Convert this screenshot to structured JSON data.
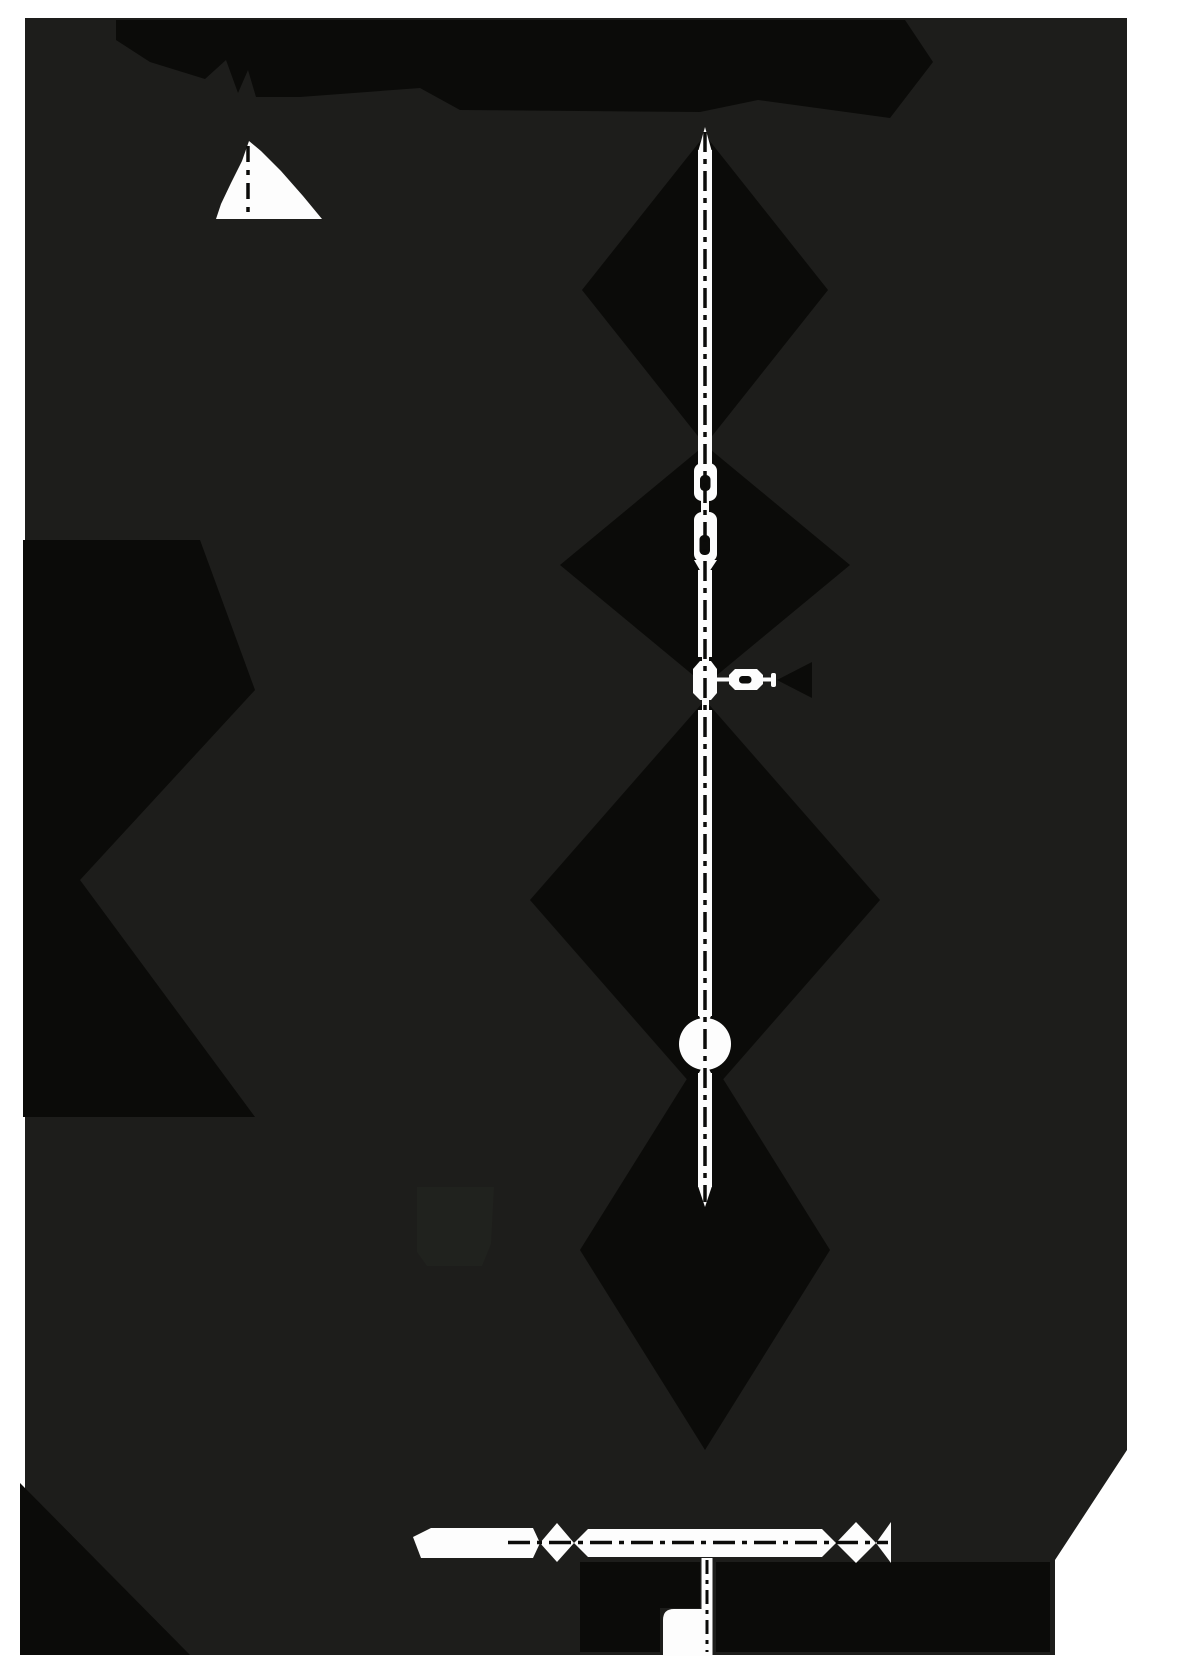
{
  "page": {
    "width": 1181,
    "height": 1680,
    "background": "#ffffff"
  },
  "figure": {
    "viewBox": "0 0 1181 1680",
    "palette": {
      "canvas": "#1d1d1b",
      "shadow": "#0b0b09",
      "white": "#fdfdfd",
      "ink": "#0b0b09",
      "faint_patch": "#20221e"
    },
    "elements": [
      {
        "name": "figure-background",
        "tag": "polygon",
        "attrs": {
          "points": "25,18 1127,18 1127,1450 1055,1560 1055,1655 25,1655",
          "fill": "#1d1d1b"
        }
      },
      {
        "name": "shadow-top-banner",
        "tag": "polygon",
        "attrs": {
          "points": "116,20 905,20 933,62 890,118 758,100 700,112 460,110 420,88 300,97 256,97 248,70 238,93 226,60 205,79 150,62 116,40",
          "fill": "#0b0b09"
        }
      },
      {
        "name": "shadow-diamond-upper",
        "tag": "polygon",
        "attrs": {
          "points": "705,135 828,290 705,445 582,290",
          "fill": "#0b0b09"
        }
      },
      {
        "name": "shadow-diamond-mid",
        "tag": "polygon",
        "attrs": {
          "points": "705,445 850,565 705,685 560,565",
          "fill": "#0b0b09"
        }
      },
      {
        "name": "shadow-diamond-lower",
        "tag": "polygon",
        "attrs": {
          "points": "705,700 880,900 705,1100 530,900",
          "fill": "#0b0b09"
        }
      },
      {
        "name": "shadow-diamond-ball",
        "tag": "polygon",
        "attrs": {
          "points": "705,1050 830,1250 705,1450 580,1250",
          "fill": "#0b0b09"
        }
      },
      {
        "name": "shadow-left-ribbon-upper",
        "tag": "polygon",
        "attrs": {
          "points": "23,540 200,540 255,690 80,880 23,880",
          "fill": "#0b0b09"
        }
      },
      {
        "name": "shadow-left-ribbon-lower",
        "tag": "polygon",
        "attrs": {
          "points": "80,880 255,1117 23,1117 23,880",
          "fill": "#0b0b09"
        }
      },
      {
        "name": "shadow-bottom-left-corner",
        "tag": "polygon",
        "attrs": {
          "points": "20,1483 190,1655 20,1655",
          "fill": "#0b0b09"
        }
      },
      {
        "name": "shadow-under-spindle-left",
        "tag": "polygon",
        "attrs": {
          "points": "580,1562 700,1562 700,1608 660,1608 660,1652 580,1652",
          "fill": "#0b0b09"
        }
      },
      {
        "name": "shadow-under-spindle-right",
        "tag": "polygon",
        "attrs": {
          "points": "716,1562 1050,1562 1050,1652 716,1652",
          "fill": "#0b0b09"
        }
      },
      {
        "name": "shadow-handle-arrowhead",
        "tag": "polygon",
        "attrs": {
          "points": "777,680 812,662 812,698",
          "fill": "#0b0b09"
        }
      },
      {
        "name": "faint-square-patch",
        "tag": "polygon",
        "attrs": {
          "points": "417,1187 494,1187 491,1244 482,1266 427,1266 417,1252",
          "fill": "#20221e"
        }
      },
      {
        "name": "cone-shape",
        "tag": "polygon",
        "attrs": {
          "points": "249,141 242,161 231,183 221,204 216,219 322,219 303,196 281,171 261,151",
          "fill": "#fdfdfd"
        }
      },
      {
        "name": "cone-axis-line",
        "tag": "line",
        "attrs": {
          "x1": 248,
          "y1": 146,
          "x2": 248,
          "y2": 219,
          "stroke": "#0b0b09",
          "stroke-width": 3.5,
          "stroke-dasharray": "16 8 5 8"
        }
      },
      {
        "name": "spindle-top-tip",
        "tag": "polygon",
        "attrs": {
          "points": "705,127 712,152 698,152",
          "fill": "#fdfdfd"
        }
      },
      {
        "name": "spindle-upper-rod",
        "tag": "rect",
        "attrs": {
          "x": 698,
          "y": 150,
          "width": 14,
          "height": 317,
          "fill": "#fdfdfd"
        }
      },
      {
        "name": "spindle-bead-top",
        "tag": "rect",
        "attrs": {
          "x": 694,
          "y": 463,
          "width": 23,
          "height": 38,
          "rx": 8,
          "fill": "#fdfdfd"
        }
      },
      {
        "name": "spindle-bead-top-hole",
        "tag": "rect",
        "attrs": {
          "x": 700,
          "y": 475,
          "width": 10.5,
          "height": 16,
          "rx": 4.5,
          "fill": "#0c0c0a"
        }
      },
      {
        "name": "spindle-neck-1",
        "tag": "rect",
        "attrs": {
          "x": 701,
          "y": 498,
          "width": 8,
          "height": 17,
          "fill": "#fdfdfd"
        }
      },
      {
        "name": "spindle-bead-bottom",
        "tag": "rect",
        "attrs": {
          "x": 694,
          "y": 512,
          "width": 23,
          "height": 50,
          "rx": 8,
          "fill": "#fdfdfd"
        }
      },
      {
        "name": "spindle-bead-bottom-hole",
        "tag": "rect",
        "attrs": {
          "x": 699.5,
          "y": 535,
          "width": 10.5,
          "height": 20,
          "rx": 4.5,
          "fill": "#0c0c0a"
        }
      },
      {
        "name": "spindle-waist",
        "tag": "polygon",
        "attrs": {
          "points": "694,560 717,560 709,572 701,572",
          "fill": "#fdfdfd"
        }
      },
      {
        "name": "spindle-mid-rod",
        "tag": "rect",
        "attrs": {
          "x": 698,
          "y": 570,
          "width": 14,
          "height": 87,
          "fill": "#fdfdfd"
        }
      },
      {
        "name": "junction-neck-top",
        "tag": "rect",
        "attrs": {
          "x": 702,
          "y": 653,
          "width": 7,
          "height": 12,
          "fill": "#fdfdfd"
        }
      },
      {
        "name": "junction-bulge",
        "tag": "polygon",
        "attrs": {
          "points": "700,661 711,661 717,669 717,693 711,700 700,700 693,693 693,669",
          "fill": "#fdfdfd"
        }
      },
      {
        "name": "junction-neck-bottom",
        "tag": "rect",
        "attrs": {
          "x": 702,
          "y": 698,
          "width": 7,
          "height": 14,
          "fill": "#fdfdfd"
        }
      },
      {
        "name": "spindle-lower-rod",
        "tag": "rect",
        "attrs": {
          "x": 698,
          "y": 710,
          "width": 14,
          "height": 306,
          "fill": "#fdfdfd"
        }
      },
      {
        "name": "ball-neck-top",
        "tag": "polygon",
        "attrs": {
          "points": "698,1014 712,1014 707,1024 703,1024",
          "fill": "#fdfdfd"
        }
      },
      {
        "name": "ball",
        "tag": "circle",
        "attrs": {
          "cx": 705,
          "cy": 1044,
          "r": 26,
          "fill": "#fdfdfd"
        }
      },
      {
        "name": "ball-neck-bottom",
        "tag": "polygon",
        "attrs": {
          "points": "703,1065 707,1065 712,1075 698,1075",
          "fill": "#fdfdfd"
        }
      },
      {
        "name": "spindle-bottom-rod",
        "tag": "rect",
        "attrs": {
          "x": 698,
          "y": 1073,
          "width": 14,
          "height": 114,
          "fill": "#fdfdfd"
        }
      },
      {
        "name": "spindle-bottom-tip",
        "tag": "polygon",
        "attrs": {
          "points": "698,1186 712,1186 705,1207",
          "fill": "#fdfdfd"
        }
      },
      {
        "name": "spindle-axis-line",
        "tag": "line",
        "attrs": {
          "x1": 705,
          "y1": 132,
          "x2": 705,
          "y2": 1202,
          "stroke": "#0b0b09",
          "stroke-width": 3.5,
          "stroke-dasharray": "20 7 5 7"
        }
      },
      {
        "name": "handle-stem",
        "tag": "line",
        "attrs": {
          "x1": 713,
          "y1": 679.5,
          "x2": 773,
          "y2": 679.5,
          "stroke": "#fdfdfd",
          "stroke-width": 4
        }
      },
      {
        "name": "handle-knob",
        "tag": "polygon",
        "attrs": {
          "points": "735,669 757,669 763,675 763,684 757,690 735,690 729,684 729,675",
          "fill": "#fdfdfd"
        }
      },
      {
        "name": "handle-knob-slot",
        "tag": "rect",
        "attrs": {
          "x": 739,
          "y": 676,
          "width": 12.5,
          "height": 7.5,
          "rx": 3.5,
          "fill": "#0c0c0a"
        }
      },
      {
        "name": "handle-end-cap",
        "tag": "rect",
        "attrs": {
          "x": 771,
          "y": 673,
          "width": 5,
          "height": 14,
          "rx": 2,
          "fill": "#fdfdfd"
        }
      },
      {
        "name": "bottom-spindle-left-block",
        "tag": "polygon",
        "attrs": {
          "points": "413,1537 431,1528 533,1528 540,1543 533,1558 421,1558",
          "fill": "#fdfdfd"
        }
      },
      {
        "name": "bottom-spindle-diamond-left",
        "tag": "polygon",
        "attrs": {
          "points": "540,1543 557,1523 574,1543 557,1562",
          "fill": "#fdfdfd"
        }
      },
      {
        "name": "bottom-spindle-band",
        "tag": "polygon",
        "attrs": {
          "points": "574,1543 588,1529 822,1529 836,1543 822,1557 588,1557",
          "fill": "#fdfdfd"
        }
      },
      {
        "name": "bottom-spindle-diamond-right",
        "tag": "polygon",
        "attrs": {
          "points": "836,1543 856,1522 876,1543 856,1563",
          "fill": "#fdfdfd"
        }
      },
      {
        "name": "bottom-spindle-cone-right",
        "tag": "polygon",
        "attrs": {
          "points": "876,1543 891,1522 891,1563",
          "fill": "#fdfdfd"
        }
      },
      {
        "name": "bottom-spindle-axis-line",
        "tag": "line",
        "attrs": {
          "x1": 508,
          "y1": 1542.5,
          "x2": 888,
          "y2": 1542.5,
          "stroke": "#0b0b09",
          "stroke-width": 3.5,
          "stroke-dasharray": "22 7 5 7"
        }
      },
      {
        "name": "bottom-axis-strip",
        "tag": "rect",
        "attrs": {
          "x": 701.5,
          "y": 1558,
          "width": 11,
          "height": 98,
          "fill": "#fdfdfd"
        }
      },
      {
        "name": "bottom-axis-line",
        "tag": "line",
        "attrs": {
          "x1": 707,
          "y1": 1560,
          "x2": 707,
          "y2": 1652,
          "stroke": "#0b0b09",
          "stroke-width": 3,
          "stroke-dasharray": "14 6 4 6"
        }
      },
      {
        "name": "bottom-white-patch",
        "tag": "path",
        "attrs": {
          "d": "M663,1620 Q663,1609 674,1609 L701.5,1609 L701.5,1656 L663,1656 Z",
          "fill": "#fdfdfd"
        }
      }
    ]
  }
}
